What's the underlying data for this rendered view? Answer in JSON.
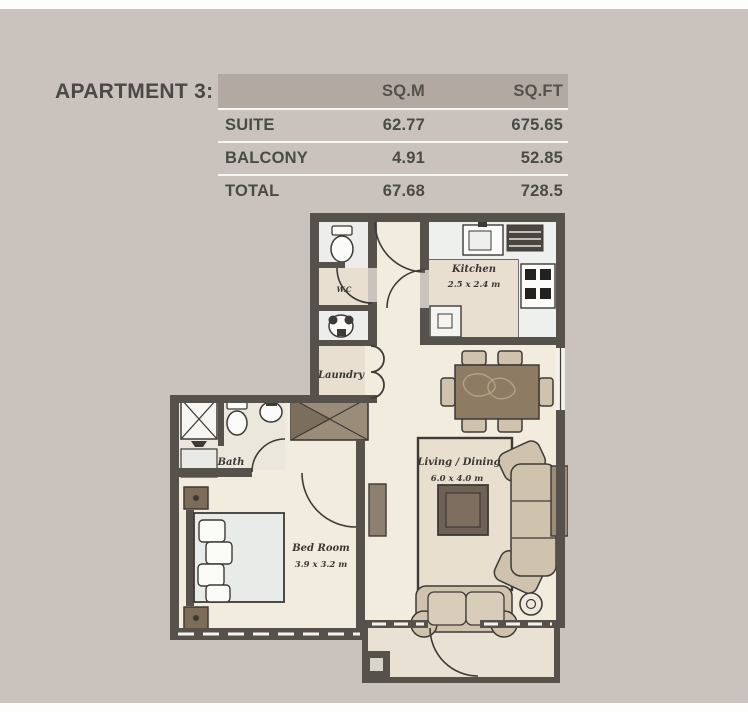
{
  "title": "APARTMENT 3:",
  "area_table": {
    "headers": {
      "sqm": "SQ.M",
      "sqft": "SQ.FT"
    },
    "rows": [
      {
        "label": "SUITE",
        "sqm": "62.77",
        "sqft": "675.65"
      },
      {
        "label": "BALCONY",
        "sqm": "4.91",
        "sqft": "52.85"
      },
      {
        "label": "TOTAL",
        "sqm": "67.68",
        "sqft": "728.5"
      }
    ]
  },
  "floorplan": {
    "rooms": {
      "kitchen": {
        "name": "Kitchen",
        "dims": "2.5 x 2.4 m"
      },
      "wc": {
        "name": "W.C"
      },
      "laundry": {
        "name": "Laundry"
      },
      "bath": {
        "name": "Bath"
      },
      "bedroom": {
        "name": "Bed Room",
        "dims": "3.9 x 3.2 m"
      },
      "living": {
        "name": "Living / Dining",
        "dims": "6.0 x 4.0 m"
      }
    },
    "colors": {
      "wall": "#57514b",
      "outline": "#3e3a35",
      "floor": "#f2ecdf",
      "wet_floor": "#edeeec",
      "label_panel": "#e8dfd0",
      "upholstery": "#cfc3ae",
      "wood": "#8d7b63",
      "dark_wood": "#6f6154",
      "closet": "#9b8c79"
    }
  },
  "page": {
    "background": "#cac3bd",
    "header_band": "#b2a9a2",
    "text_color": "#4c4a47"
  }
}
